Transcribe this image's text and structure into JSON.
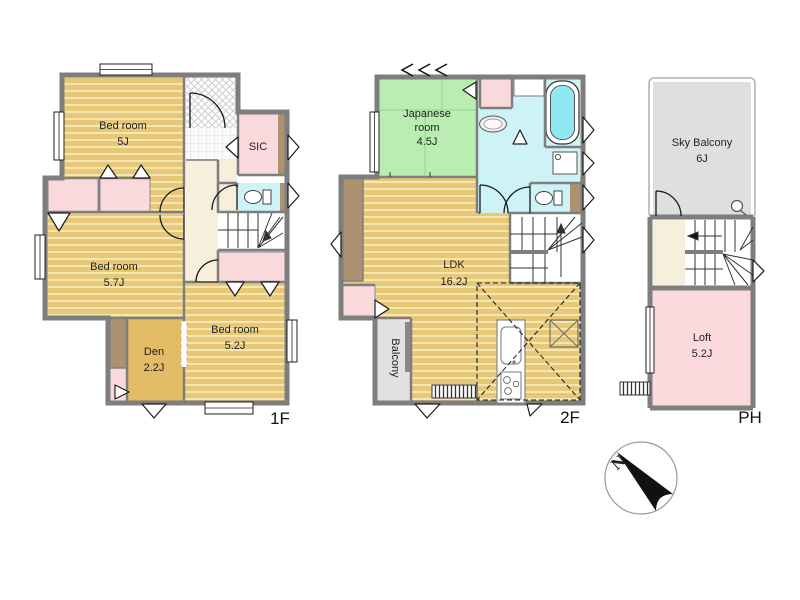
{
  "colors": {
    "wall": "#7E7E7E",
    "wood_floor": "#E8C877",
    "wood_stripe": "#F5E7B3",
    "tatami_green": "#B9EDB2",
    "closet_pink": "#FAD9DC",
    "wet_area_cyan": "#CDF3F7",
    "bathtub_cyan": "#8FE8F2",
    "hall_cream": "#F6EFDB",
    "closet_brown": "#AC9271",
    "den_tan": "#E2BB64",
    "balcony_gray": "#E2E2E2",
    "sky_balcony_gray": "#DFDFDF",
    "loft_pink": "#FBD9DC"
  },
  "floors": [
    {
      "label": "1F",
      "rooms": [
        {
          "name": "bedroom-5j",
          "lines": [
            "Bed room",
            "5J"
          ]
        },
        {
          "name": "sic",
          "lines": [
            "SIC"
          ]
        },
        {
          "name": "bedroom-5-7j",
          "lines": [
            "Bed room",
            "5.7J"
          ]
        },
        {
          "name": "den",
          "lines": [
            "Den",
            "2.2J"
          ]
        },
        {
          "name": "bedroom-5-2j",
          "lines": [
            "Bed room",
            "5.2J"
          ]
        }
      ]
    },
    {
      "label": "2F",
      "rooms": [
        {
          "name": "japanese-room",
          "lines": [
            "Japanese",
            "room",
            "4.5J"
          ]
        },
        {
          "name": "ldk",
          "lines": [
            "LDK",
            "16.2J"
          ]
        },
        {
          "name": "balcony",
          "lines": [
            "Balcony"
          ]
        }
      ]
    },
    {
      "label": "PH",
      "rooms": [
        {
          "name": "sky-balcony",
          "lines": [
            "Sky Balcony",
            "6J"
          ]
        },
        {
          "name": "loft",
          "lines": [
            "Loft",
            "5.2J"
          ]
        }
      ]
    }
  ],
  "compass": {
    "label": "N"
  },
  "fixtures": [
    "entrance-door",
    "shoe-closet",
    "toilet",
    "staircase",
    "closet",
    "window",
    "bathtub",
    "washbasin",
    "washing-machine",
    "kitchen-sink",
    "gas-stove",
    "loft-ladder",
    "sliding-door",
    "north-compass"
  ]
}
